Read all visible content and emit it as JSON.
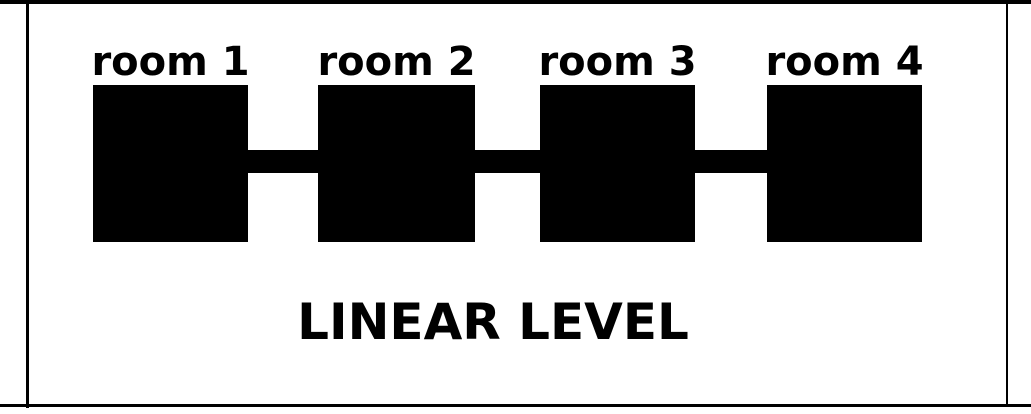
{
  "diagram": {
    "title": "LINEAR LEVEL",
    "rooms": [
      {
        "label": "room 1"
      },
      {
        "label": "room 2"
      },
      {
        "label": "room 3"
      },
      {
        "label": "room 4"
      }
    ],
    "connections": [
      {
        "from": "room 1",
        "to": "room 2"
      },
      {
        "from": "room 2",
        "to": "room 3"
      },
      {
        "from": "room 3",
        "to": "room 4"
      }
    ],
    "colors": {
      "ink": "#000000",
      "background": "#ffffff"
    }
  }
}
